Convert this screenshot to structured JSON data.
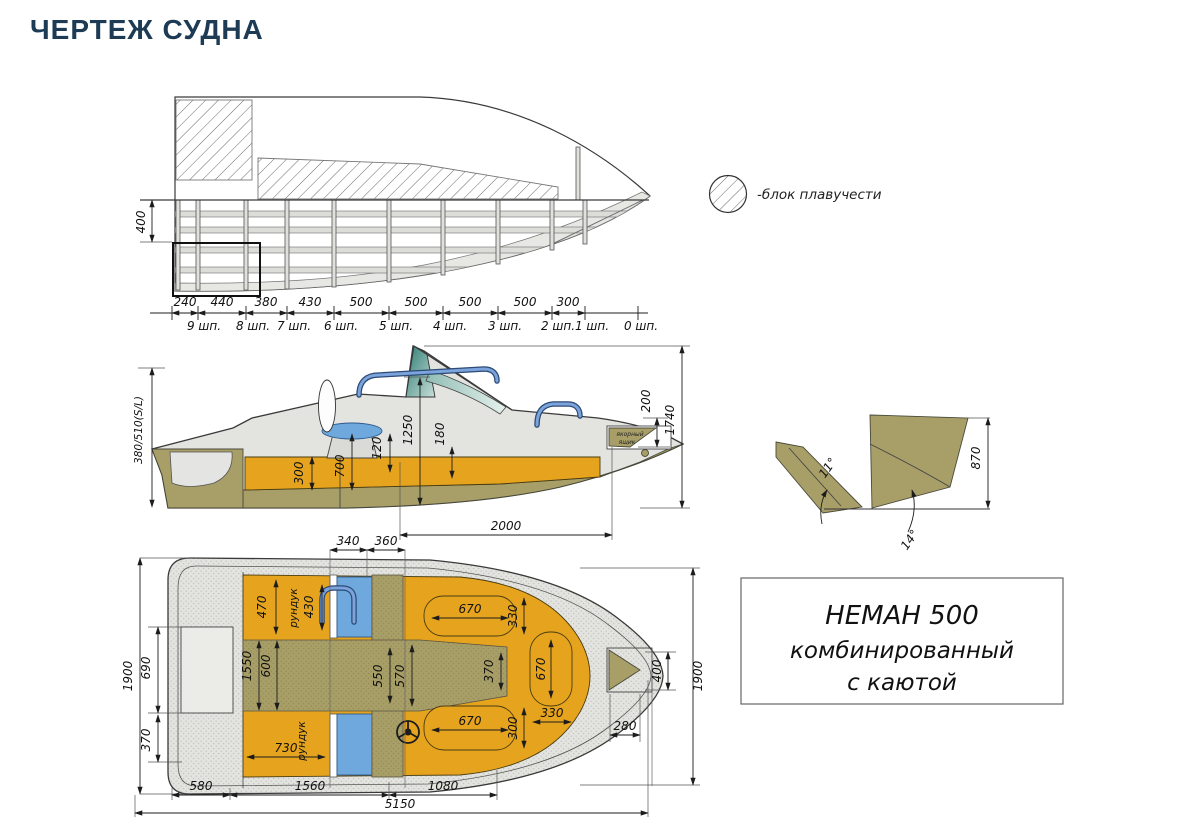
{
  "page": {
    "title": "ЧЕРТЕЖ СУДНА"
  },
  "legend": {
    "label": "-блок плавучести"
  },
  "profile": {
    "height_dim": "400",
    "dims": [
      "240",
      "440",
      "380",
      "430",
      "500",
      "500",
      "500",
      "500",
      "300"
    ],
    "stations": [
      "9 шп.",
      "8 шп.",
      "7 шп.",
      "6 шп.",
      "5 шп.",
      "4 шп.",
      "3 шп.",
      "2 шп.",
      "1 шп.",
      "0 шп."
    ]
  },
  "side": {
    "freeboard": "380/510(S/L)",
    "backrest_h": "300",
    "table_h": "700",
    "gap": "120",
    "cabin_h": "1250",
    "seat_h": "180",
    "bow_locker_h": "200",
    "overall_h": "1740",
    "cockpit_len": "2000",
    "anchor1": "якорный",
    "anchor2": "ящик"
  },
  "transom": {
    "height": "870",
    "angle_chine": "11°",
    "angle_bottom": "14°"
  },
  "plan": {
    "top_dims": [
      "340",
      "360"
    ],
    "left_dims": {
      "beam": "1900",
      "well_len": "690",
      "well_off": "370"
    },
    "bottom_dims": {
      "d1": "580",
      "d2": "1560",
      "d3": "1080",
      "total": "5150"
    },
    "right_dims": {
      "bow_w": "400",
      "beam": "1900",
      "locker": "280"
    },
    "locker_top": {
      "w": "470",
      "label": "рундук",
      "len": "430"
    },
    "locker_bottom": {
      "w": "730",
      "label": "рундук"
    },
    "walkway": {
      "w1": "1550",
      "w2": "600",
      "w3": "550",
      "w4": "570",
      "w5": "370"
    },
    "seat_top": {
      "l": "670",
      "w": "330"
    },
    "seat_bottom": {
      "l": "670",
      "w": "300"
    },
    "seat_bow": {
      "l": "670",
      "w": "330"
    }
  },
  "title_block": {
    "line1": "НЕМАН 500",
    "line2": "комбинированный",
    "line3": "с каютой"
  },
  "colors": {
    "orange": "#E6A41E",
    "khaki": "#A89F68",
    "seat_blue": "#6FA8DC",
    "glass_teal": "#4E958C",
    "rail_blue": "#7BA3DC",
    "hull_gray": "#E3E3E0",
    "title_navy": "#1D3B55"
  }
}
